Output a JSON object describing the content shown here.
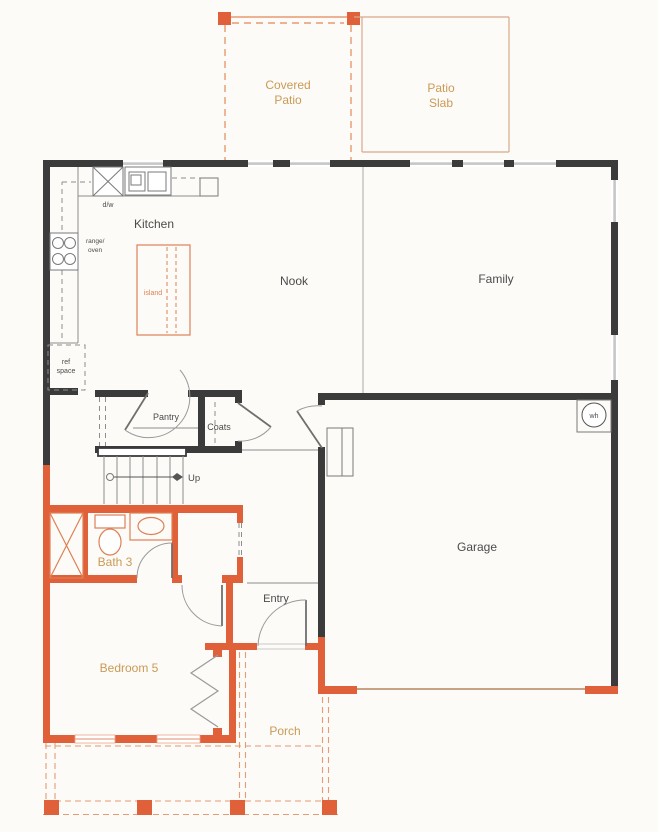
{
  "colors": {
    "background": "#fcfbf8",
    "wall_dark": "#3b3b3b",
    "wall_orange": "#e0603a",
    "fixture_orange": "#dd8055",
    "dash_orange": "#e89a70",
    "slab_tan": "#d9a88a",
    "label_tan": "#cb9a55",
    "label_dark": "#4b4b4b",
    "line_gray": "#8d8d8d",
    "window_gray": "#c7c7c7"
  },
  "rooms": {
    "covered_patio": {
      "label_line1": "Covered",
      "label_line2": "Patio"
    },
    "patio_slab": {
      "label_line1": "Patio",
      "label_line2": "Slab"
    },
    "kitchen": {
      "label": "Kitchen"
    },
    "nook": {
      "label": "Nook"
    },
    "family": {
      "label": "Family"
    },
    "pantry": {
      "label": "Pantry"
    },
    "coats": {
      "label": "Coats"
    },
    "garage": {
      "label": "Garage"
    },
    "bath3": {
      "label": "Bath 3"
    },
    "bedroom5": {
      "label": "Bedroom 5"
    },
    "entry": {
      "label": "Entry"
    },
    "porch": {
      "label": "Porch"
    }
  },
  "fixtures": {
    "dishwasher": "d/w",
    "range_oven_line1": "range/",
    "range_oven_line2": "oven",
    "ref_space_line1": "ref",
    "ref_space_line2": "space",
    "island": "island",
    "water_heater": "wh",
    "stairs_direction": "Up"
  }
}
